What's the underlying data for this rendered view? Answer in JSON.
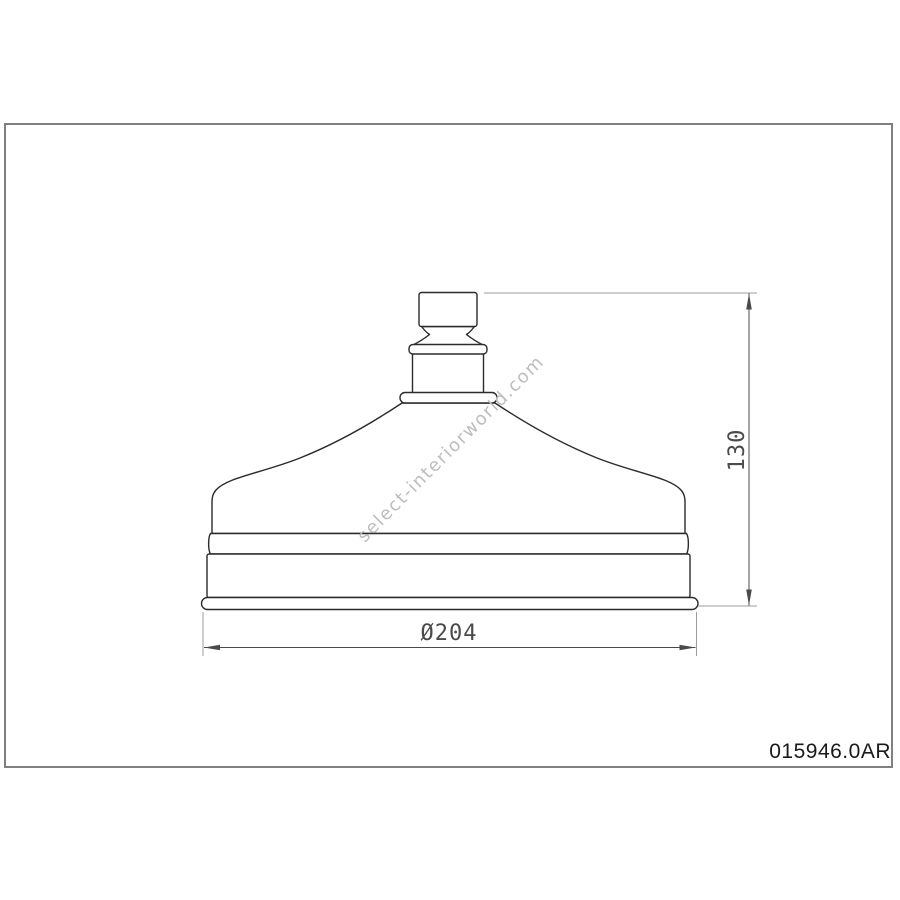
{
  "sheet": {
    "watermark": "select-interiorworld.com",
    "part_number": "015946.0AR"
  },
  "dimensions": {
    "diameter_label": "Ø204",
    "height_label": "130"
  },
  "colors": {
    "bg": "#ffffff",
    "border": "#808080",
    "outline": "#2b2b2b",
    "dimension_line": "#4a4a4a",
    "extension_line": "#9c9c9c",
    "watermark": "#bdbdbd"
  }
}
